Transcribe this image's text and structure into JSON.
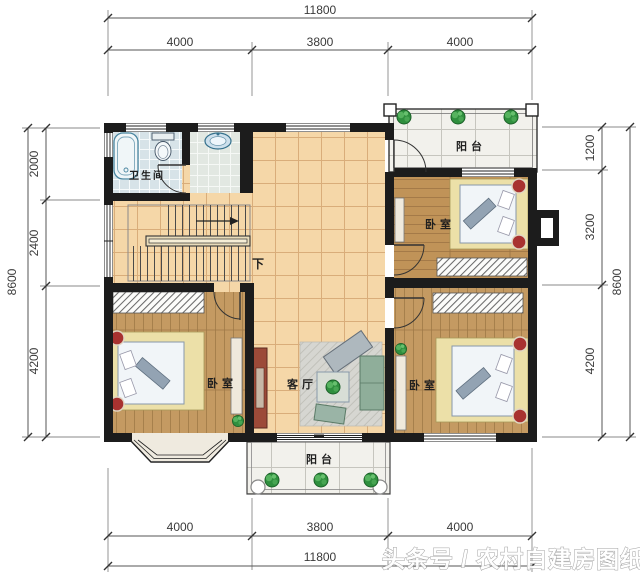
{
  "plan": {
    "rooms": {
      "bathroom": "卫生间",
      "balcony_top": "阳台",
      "balcony_bottom": "阳台",
      "bedroom_top_right": "卧室",
      "bedroom_bottom_left": "卧室",
      "bedroom_bottom_right": "卧室",
      "living_room": "客厅",
      "stairs_down": "下"
    },
    "dimensions": {
      "top": {
        "total": "11800",
        "segments": [
          "4000",
          "3800",
          "4000"
        ]
      },
      "bottom": {
        "total": "11800",
        "segments": [
          "4000",
          "3800",
          "4000"
        ]
      },
      "left": {
        "total": "8600",
        "segments": [
          "2000",
          "2400",
          "4200"
        ]
      },
      "right": {
        "total": "8600",
        "segments": [
          "1200",
          "3200",
          "4200"
        ]
      }
    },
    "watermark": "头条号 / 农村自建房图纸",
    "colors": {
      "wall": "#1c1c1c",
      "hall_tile": "#f5d7a8",
      "wood_floor": "#c49a62",
      "bathroom_tile": "#d7e3e8",
      "balcony_tile": "#f2f1ec",
      "plant_green": "#2f8f3e",
      "accent_red": "#a83230",
      "bed_surround": "#ece0a8",
      "dimension_text": "#3a3a3a"
    }
  }
}
